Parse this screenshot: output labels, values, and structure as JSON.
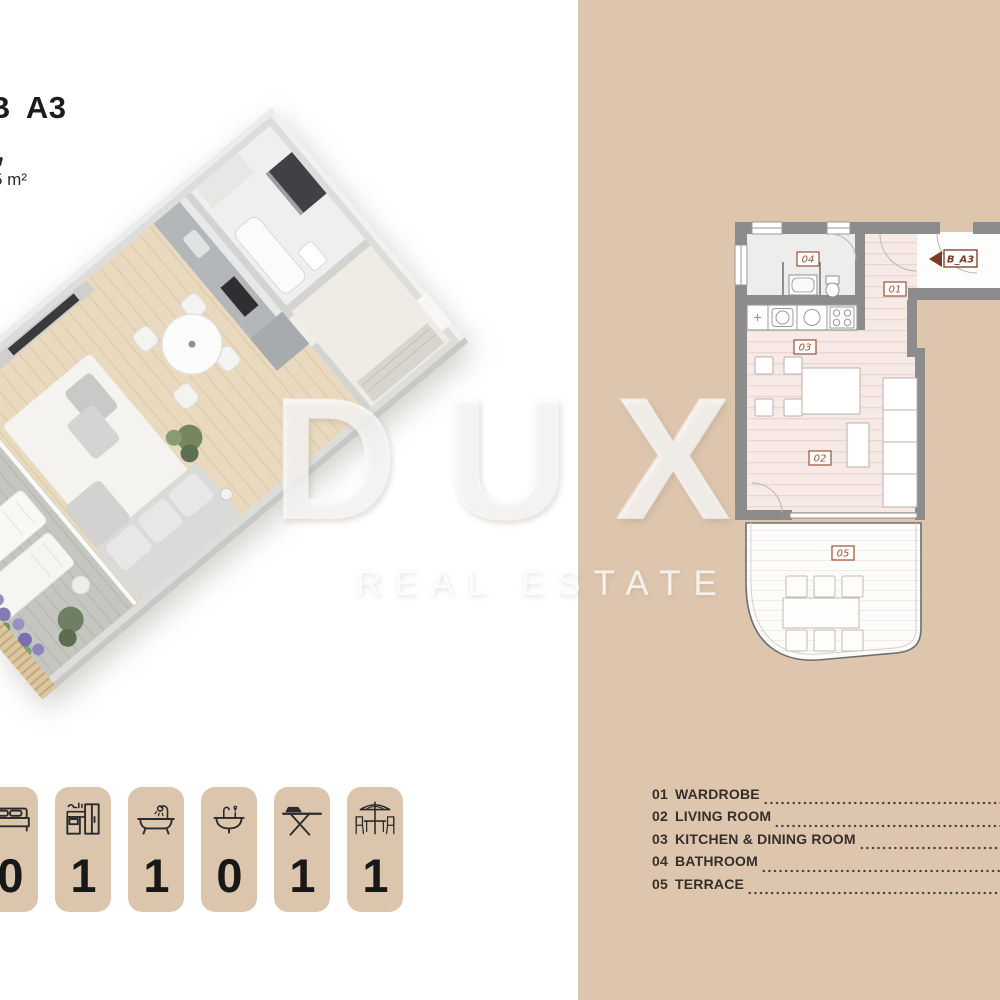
{
  "header": {
    "title": "B A3",
    "title_part1": "B",
    "title_part2": "A3",
    "area": "5 m²"
  },
  "watermark": {
    "brand": "DUX",
    "tagline": "REAL ESTATE"
  },
  "colors": {
    "panel_tan": "#dec6ae",
    "wall_gray": "#8c8c8c",
    "floor_pink": "#f7eae6",
    "accent_brown": "#9b4f35",
    "marker_brown": "#7b3b22",
    "text_dark": "#352f28"
  },
  "plan2d": {
    "unit_marker": "B_A3",
    "room_labels": {
      "wardrobe": "01",
      "living": "02",
      "kitchen": "03",
      "bathroom": "04",
      "terrace": "05"
    }
  },
  "legend": {
    "items": [
      {
        "number": "01",
        "label": "WARDROBE"
      },
      {
        "number": "02",
        "label": "LIVING ROOM"
      },
      {
        "number": "03",
        "label": "KITCHEN & DINING ROOM"
      },
      {
        "number": "04",
        "label": "BATHROOM"
      },
      {
        "number": "05",
        "label": "TERRACE"
      }
    ]
  },
  "amenities": [
    {
      "icon": "bed-icon",
      "count": "0"
    },
    {
      "icon": "kitchen-icon",
      "count": "1"
    },
    {
      "icon": "bathtub-icon",
      "count": "1"
    },
    {
      "icon": "sink-icon",
      "count": "0"
    },
    {
      "icon": "ironing-board-icon",
      "count": "1"
    },
    {
      "icon": "patio-table-icon",
      "count": "1"
    }
  ]
}
